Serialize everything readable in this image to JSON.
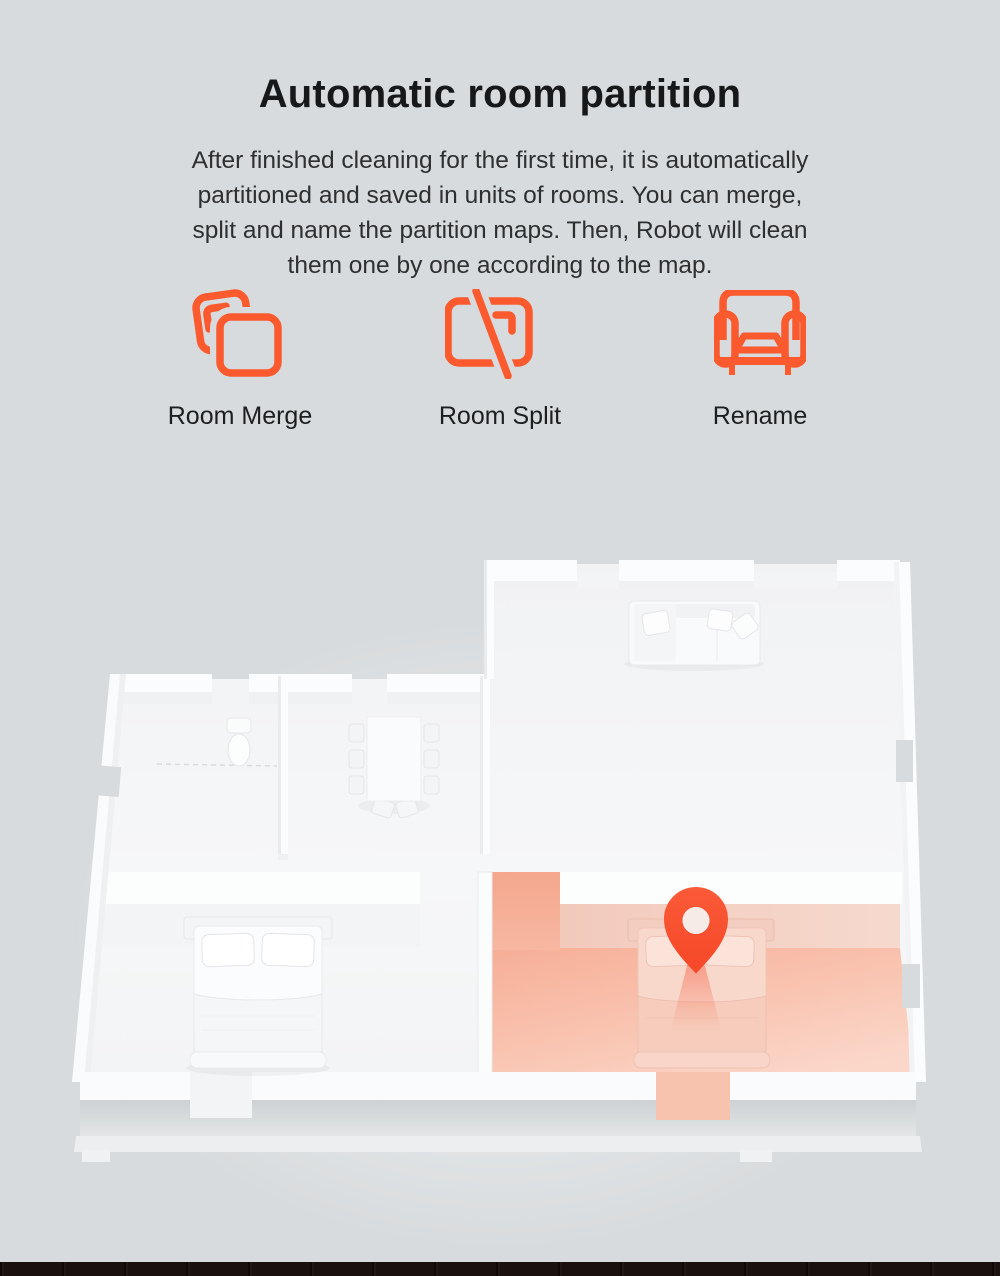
{
  "page": {
    "background_color": "#d8dbdd",
    "bottom_strip_color": "#1a100d"
  },
  "header": {
    "title": "Automatic room partition",
    "description_lines": [
      "After finished cleaning for the first time, it is automatically",
      "partitioned and saved in units of rooms. You can merge,",
      "split and name the partition maps. Then, Robot will clean",
      "them one by one according to the map."
    ]
  },
  "features": [
    {
      "icon": "room-merge-icon",
      "label": "Room Merge"
    },
    {
      "icon": "room-split-icon",
      "label": "Room Split"
    },
    {
      "icon": "rename-icon",
      "label": "Rename"
    }
  ],
  "theme": {
    "accent_color": "#fa5a2d",
    "pin_color": "#f64828",
    "room_highlight_color": "#f6ae96",
    "title_color": "#17181a",
    "body_text_color": "#2e2f30"
  },
  "floorplan": {
    "description": "3D top-down apartment render",
    "rooms": [
      {
        "name": "living-room",
        "furniture": [
          "sofa"
        ],
        "highlighted": false
      },
      {
        "name": "bathroom",
        "furniture": [
          "toilet"
        ],
        "highlighted": false
      },
      {
        "name": "dining-area",
        "furniture": [
          "dining-table",
          "chairs"
        ],
        "highlighted": false
      },
      {
        "name": "bedroom-left",
        "furniture": [
          "double-bed"
        ],
        "highlighted": false
      },
      {
        "name": "bedroom-right",
        "furniture": [
          "double-bed"
        ],
        "highlighted": true,
        "marker": "location-pin"
      }
    ]
  }
}
